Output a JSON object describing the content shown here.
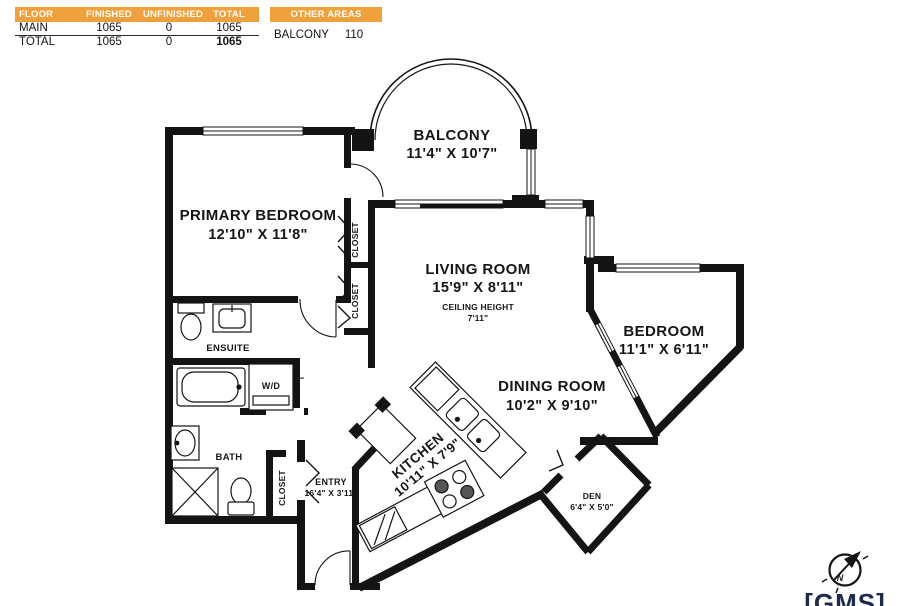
{
  "colors": {
    "header_orange": "#F1A13C",
    "wall": "#141414",
    "logo_navy": "#1D2B4D"
  },
  "area_table": {
    "headers": [
      "FLOOR",
      "FINISHED",
      "UNFINISHED",
      "TOTAL"
    ],
    "rows": [
      {
        "floor": "MAIN",
        "finished": "1065",
        "unfinished": "0",
        "total": "1065"
      },
      {
        "floor": "TOTAL",
        "finished": "1065",
        "unfinished": "0",
        "total": "1065"
      }
    ]
  },
  "other_areas": {
    "header": "OTHER AREAS",
    "rows": [
      {
        "name": "BALCONY",
        "area": "110"
      }
    ]
  },
  "rooms": {
    "balcony": {
      "name": "BALCONY",
      "dims": "11'4\" X 10'7\""
    },
    "primary_bedroom": {
      "name": "PRIMARY BEDROOM",
      "dims": "12'10\" X 11'8\""
    },
    "living_room": {
      "name": "LIVING ROOM",
      "dims": "15'9\" X 8'11\"",
      "ceiling_label": "CEILING HEIGHT",
      "ceiling_value": "7'11\""
    },
    "bedroom": {
      "name": "BEDROOM",
      "dims": "11'1\" X 6'11\""
    },
    "dining_room": {
      "name": "DINING ROOM",
      "dims": "10'2\" X 9'10\""
    },
    "kitchen": {
      "name": "KITCHEN",
      "dims": "10'11\" X 7'9\""
    },
    "den": {
      "name": "DEN",
      "dims": "6'4\" X 5'0\""
    },
    "entry": {
      "name": "ENTRY",
      "dims": "16'4\" X 3'11\""
    },
    "ensuite": {
      "name": "ENSUITE"
    },
    "bath": {
      "name": "BATH"
    },
    "laundry": {
      "name": "W/D"
    },
    "closet": {
      "name": "CLOSET"
    }
  },
  "compass": {
    "north": "N"
  },
  "logo": {
    "text": "[GMS]"
  }
}
